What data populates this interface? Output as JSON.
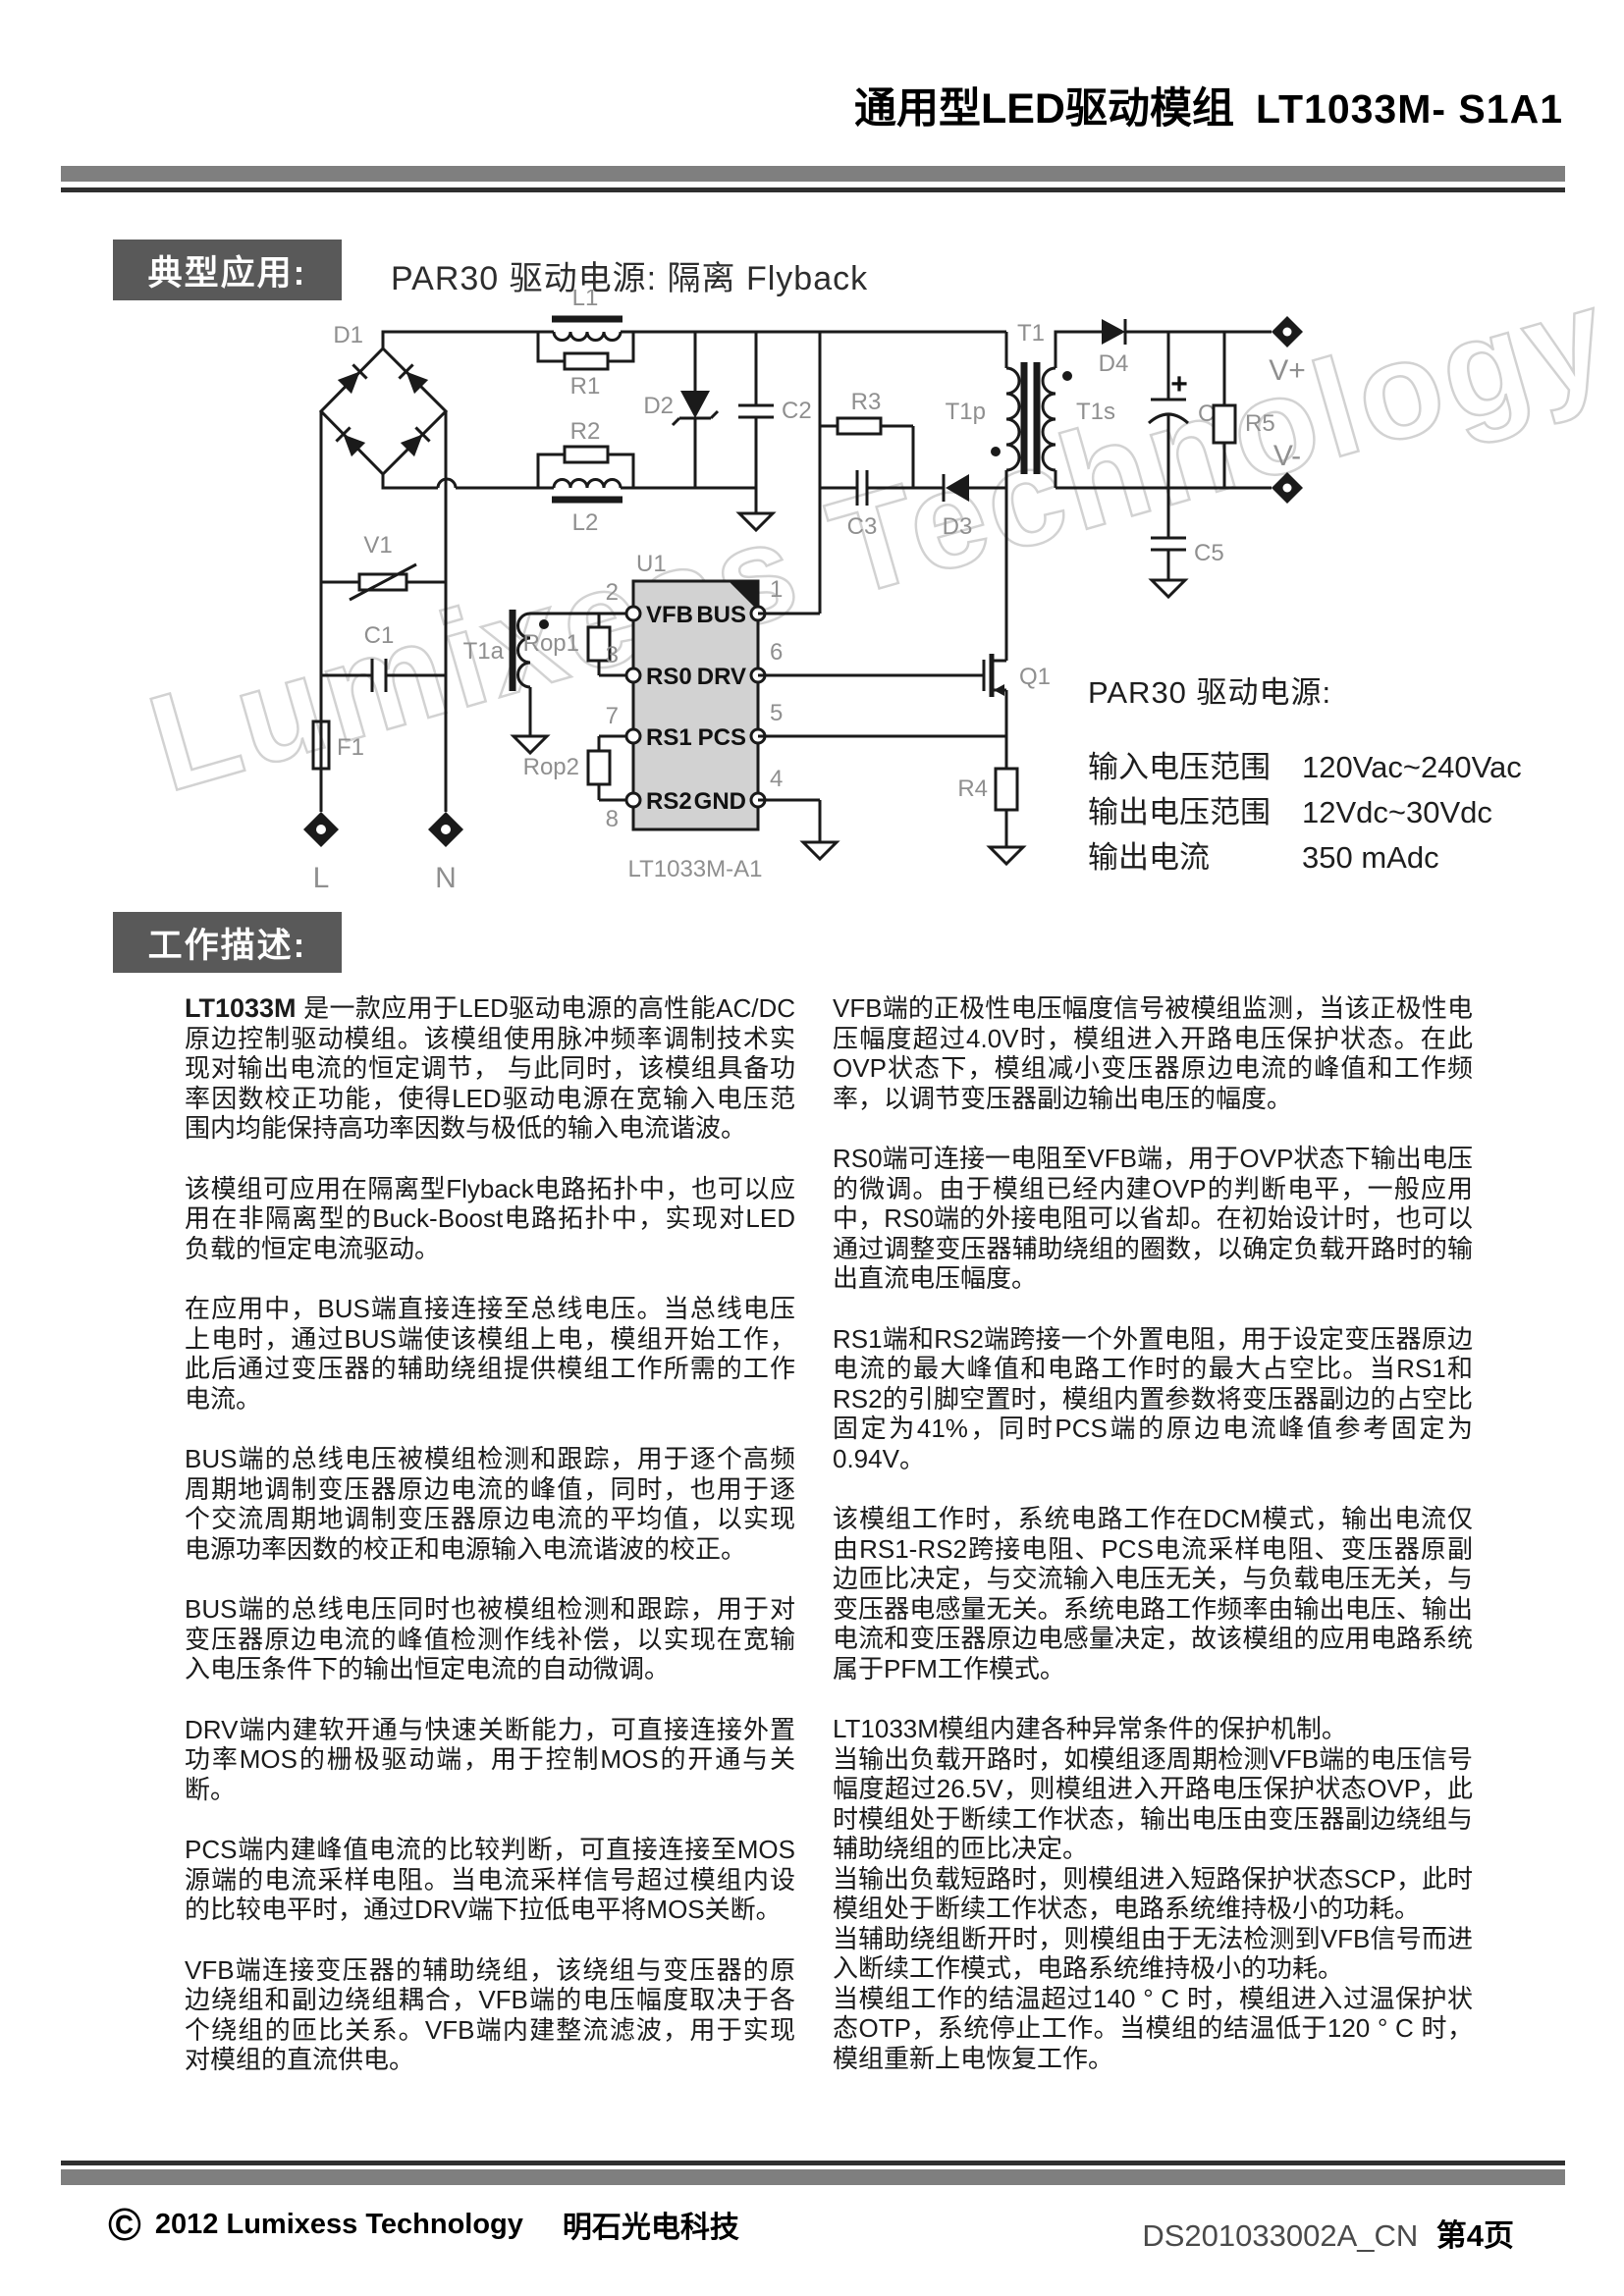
{
  "header": {
    "title_cn": "通用型LED驱动模组",
    "title_model": "LT1033M- S1A1"
  },
  "sections": {
    "typical_app_label": "典型应用:",
    "typical_app_title": "PAR30 驱动电源: 隔离 Flyback",
    "work_desc_label": "工作描述:"
  },
  "watermark": "Lumixess Technology",
  "colors": {
    "header_bar": "#7f7f7f",
    "section_box": "#595959",
    "chip_fill": "#d2d2d2"
  },
  "schematic": {
    "labels": {
      "d1": "D1",
      "l1": "L1",
      "r1": "R1",
      "r2": "R2",
      "l2": "L2",
      "v1": "V1",
      "c1": "C1",
      "f1": "F1",
      "t1a": "T1a",
      "rop1": "Rop1",
      "rop2": "Rop2",
      "d2": "D2",
      "c2": "C2",
      "r3": "R3",
      "c3": "C3",
      "d3": "D3",
      "t1": "T1",
      "t1p": "T1p",
      "t1s": "T1s",
      "d4": "D4",
      "c4": "C4",
      "r5": "R5",
      "c5": "C5",
      "q1": "Q1",
      "r4": "R4",
      "plus": "+"
    },
    "chip": {
      "ref": "U1",
      "part": "LT1033M-A1",
      "pins_left": [
        {
          "num": "2",
          "name": "VFB"
        },
        {
          "num": "3",
          "name": "RS0"
        },
        {
          "num": "7",
          "name": "RS1"
        },
        {
          "num": "8",
          "name": "RS2"
        }
      ],
      "pins_right": [
        {
          "num": "1",
          "name": "BUS"
        },
        {
          "num": "6",
          "name": "DRV"
        },
        {
          "num": "5",
          "name": "PCS"
        },
        {
          "num": "4",
          "name": "GND"
        }
      ]
    },
    "terminals": {
      "line": "L",
      "neutral": "N",
      "vplus": "V+",
      "vminus": "V-"
    }
  },
  "specs": {
    "heading": "PAR30 驱动电源:",
    "rows": [
      {
        "label": "输入电压范围",
        "value": "120Vac~240Vac"
      },
      {
        "label": "输出电压范围",
        "value": "12Vdc~30Vdc"
      },
      {
        "label": "输出电流",
        "value": "350 mAdc"
      }
    ]
  },
  "description": {
    "left_bold": "LT1033M",
    "left": [
      " 是一款应用于LED驱动电源的高性能AC/DC原边控制驱动模组。该模组使用脉冲频率调制技术实现对输出电流的恒定调节， 与此同时，该模组具备功率因数校正功能，使得LED驱动电源在宽输入电压范围内均能保持高功率因数与极低的输入电流谐波。",
      "该模组可应用在隔离型Flyback电路拓扑中，也可以应用在非隔离型的Buck-Boost电路拓扑中，实现对LED负载的恒定电流驱动。",
      "在应用中，BUS端直接连接至总线电压。当总线电压上电时，通过BUS端使该模组上电，模组开始工作，此后通过变压器的辅助绕组提供模组工作所需的工作电流。",
      "BUS端的总线电压被模组检测和跟踪，用于逐个高频周期地调制变压器原边电流的峰值，同时，也用于逐个交流周期地调制变压器原边电流的平均值，以实现电源功率因数的校正和电源输入电流谐波的校正。",
      "BUS端的总线电压同时也被模组检测和跟踪，用于对变压器原边电流的峰值检测作线补偿，以实现在宽输入电压条件下的输出恒定电流的自动微调。",
      "DRV端内建软开通与快速关断能力，可直接连接外置功率MOS的栅极驱动端，用于控制MOS的开通与关断。",
      "PCS端内建峰值电流的比较判断，可直接连接至MOS源端的电流采样电阻。当电流采样信号超过模组内设的比较电平时，通过DRV端下拉低电平将MOS关断。",
      "VFB端连接变压器的辅助绕组，该绕组与变压器的原边绕组和副边绕组耦合，VFB端的电压幅度取决于各个绕组的匝比关系。VFB端内建整流滤波，用于实现对模组的直流供电。"
    ],
    "right": [
      "VFB端的正极性电压幅度信号被模组监测，当该正极性电压幅度超过4.0V时，模组进入开路电压保护状态。在此OVP状态下，模组减小变压器原边电流的峰值和工作频率，以调节变压器副边输出电压的幅度。",
      "RS0端可连接一电阻至VFB端，用于OVP状态下输出电压的微调。由于模组已经内建OVP的判断电平，一般应用中，RS0端的外接电阻可以省却。在初始设计时，也可以通过调整变压器辅助绕组的圈数，以确定负载开路时的输出直流电压幅度。",
      "RS1端和RS2端跨接一个外置电阻，用于设定变压器原边电流的最大峰值和电路工作时的最大占空比。当RS1和RS2的引脚空置时，模组内置参数将变压器副边的占空比固定为41%，同时PCS端的原边电流峰值参考固定为0.94V。",
      "该模组工作时，系统电路工作在DCM模式，输出电流仅由RS1-RS2跨接电阻、PCS电流采样电阻、变压器原副边匝比决定，与交流输入电压无关，与负载电压无关，与变压器电感量无关。系统电路工作频率由输出电压、输出电流和变压器原边电感量决定，故该模组的应用电路系统属于PFM工作模式。"
    ],
    "protection": [
      "LT1033M模组内建各种异常条件的保护机制。",
      "当输出负载开路时，如模组逐周期检测VFB端的电压信号幅度超过26.5V，则模组进入开路电压保护状态OVP，此时模组处于断续工作状态，输出电压由变压器副边绕组与辅助绕组的匝比决定。",
      "当输出负载短路时，则模组进入短路保护状态SCP，此时模组处于断续工作状态，电路系统维持极小的功耗。",
      "当辅助绕组断开时，则模组由于无法检测到VFB信号而进入断续工作模式，电路系统维持极小的功耗。",
      "当模组工作的结温超过140 ° C 时，模组进入过温保护状态OTP，系统停止工作。当模组的结温低于120 ° C 时，模组重新上电恢复工作。"
    ]
  },
  "footer": {
    "copyright_symbol": "©",
    "year_company": "2012  Lumixess Technology",
    "company_cn": "明石光电科技",
    "doc_number": "DS201033002A_CN",
    "page": "第4页"
  }
}
